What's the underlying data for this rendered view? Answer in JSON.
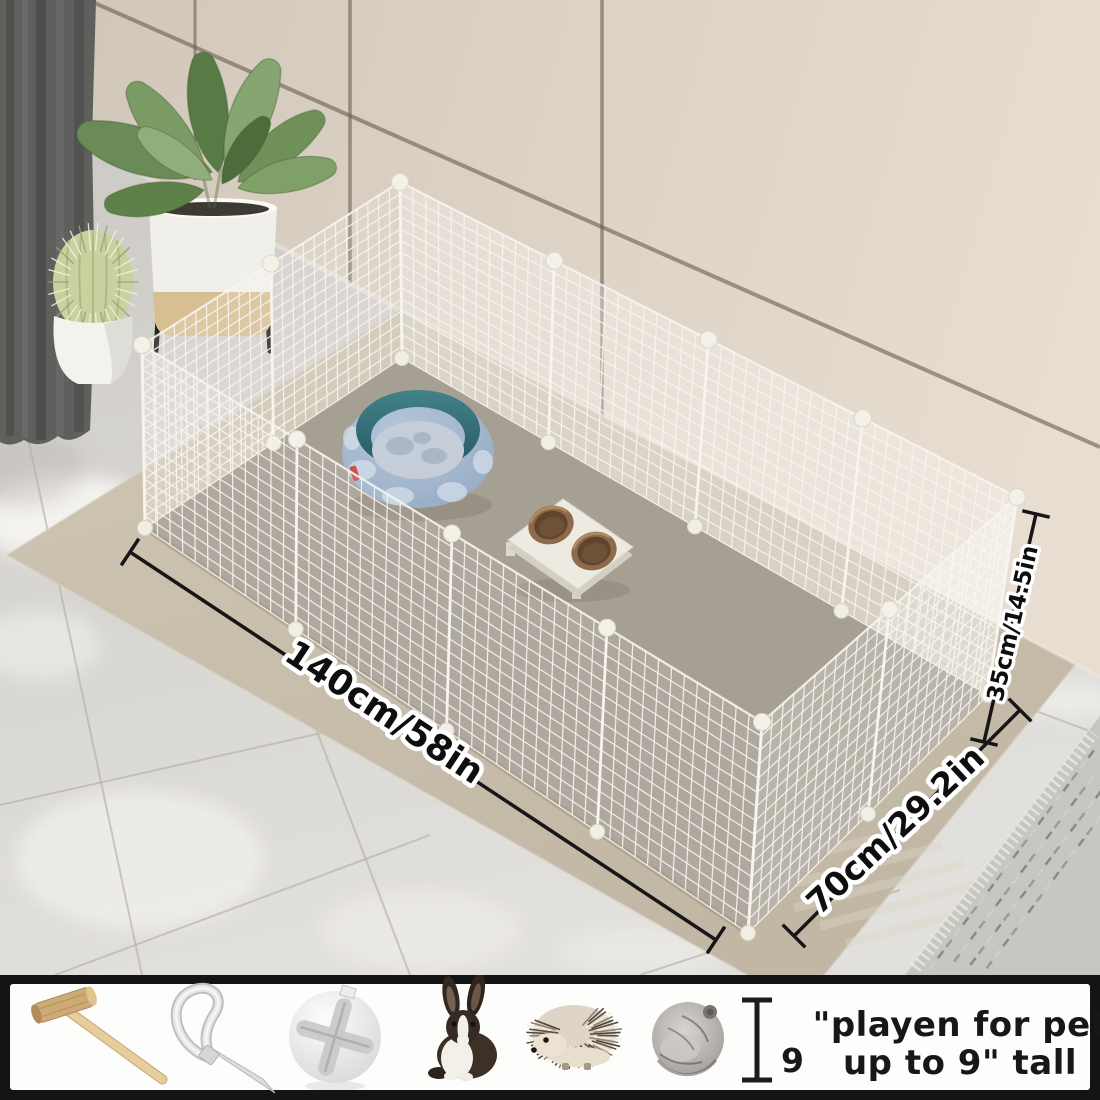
{
  "scene": {
    "description": "white wire-grid pet playpen on beige rug in room corner",
    "dimension_labels": {
      "length": "140cm/58in",
      "depth": "70cm/29.2in",
      "height": "35cm/14.5in"
    }
  },
  "legend": {
    "icons": [
      "wooden-mallet-icon",
      "cable-tie-icon",
      "ball-connector-icon",
      "rabbit-icon",
      "hedgehog-icon",
      "hamster-icon"
    ],
    "height_gauge": {
      "value": "9",
      "caption_line1": "\"playen for pet",
      "caption_line2": "up to 9\" tall"
    }
  },
  "colors": {
    "wall": "#ddd3c6",
    "floor": "#d6d4d0",
    "rug": "#c8bfad",
    "interior_mat": "#a69f93",
    "wire": "#f6f3ec",
    "curtain": "#5f5f5d",
    "bed_rim_teal": "#3a7a82",
    "bed_fabric_blue": "#a3b8d0",
    "bowl_brown": "#8d6a4a",
    "dimension_text": "#0e0e0e",
    "strip_border": "#141414",
    "strip_bg": "#fdfdfc"
  }
}
